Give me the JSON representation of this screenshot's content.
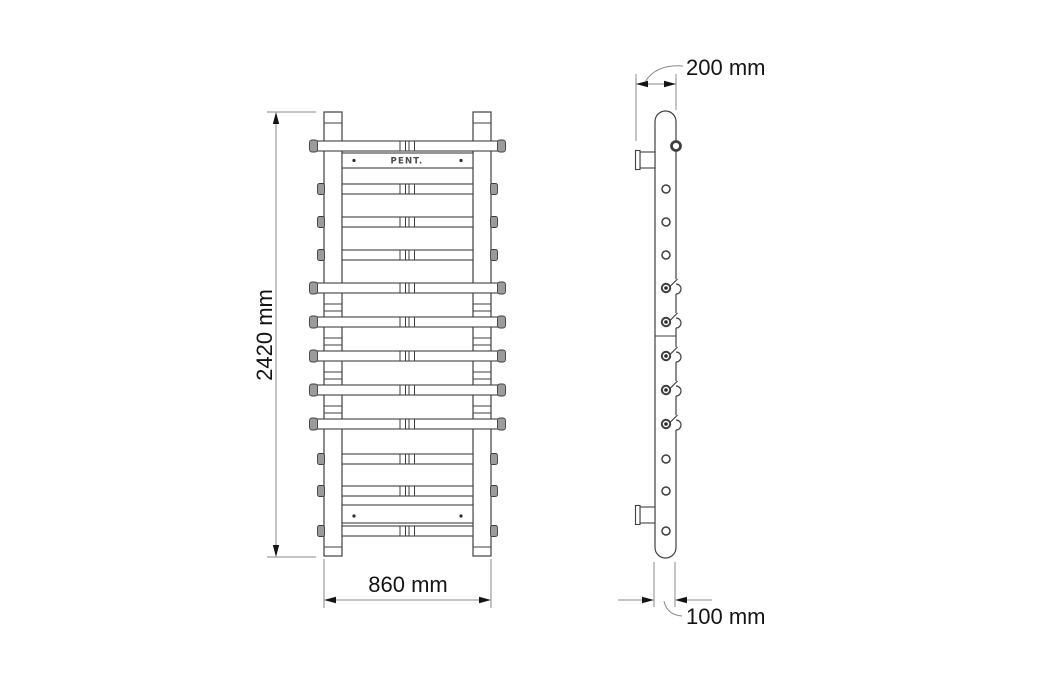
{
  "drawing": {
    "brand": "PENT.",
    "dimensions": {
      "height": "2420 mm",
      "width": "860 mm",
      "depth_top": "200 mm",
      "depth_bottom": "100 mm"
    },
    "colors": {
      "outline": "#3f3f3f",
      "dimension_lines": "#8a8a8a",
      "text": "#141414",
      "cap_fill": "#9b9b9b",
      "background": "#ffffff"
    }
  }
}
